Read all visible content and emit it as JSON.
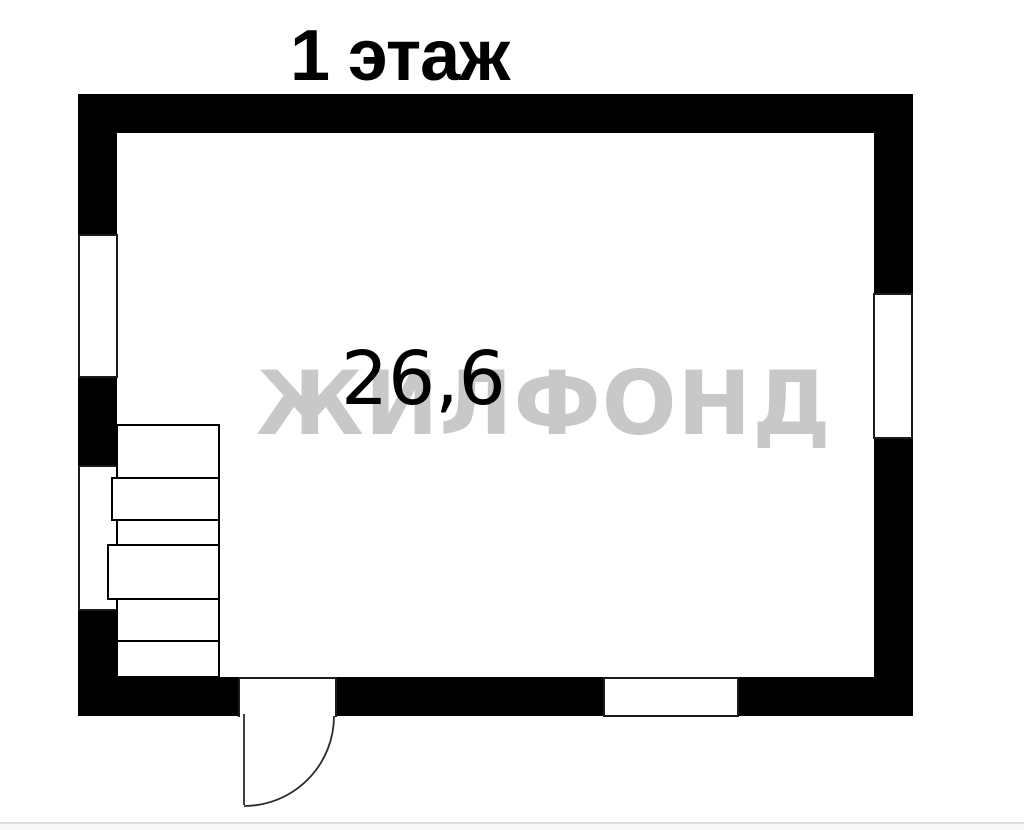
{
  "title": "1 этаж",
  "room": {
    "area_label": "26,6"
  },
  "watermark": {
    "text": "ЖИЛФОНД"
  },
  "colors": {
    "wall": "#000000",
    "outline": "#1c1c1c",
    "door_line": "#2b2b2b",
    "watermark": "#c8c8c8",
    "background": "#ffffff",
    "text": "#000000"
  }
}
